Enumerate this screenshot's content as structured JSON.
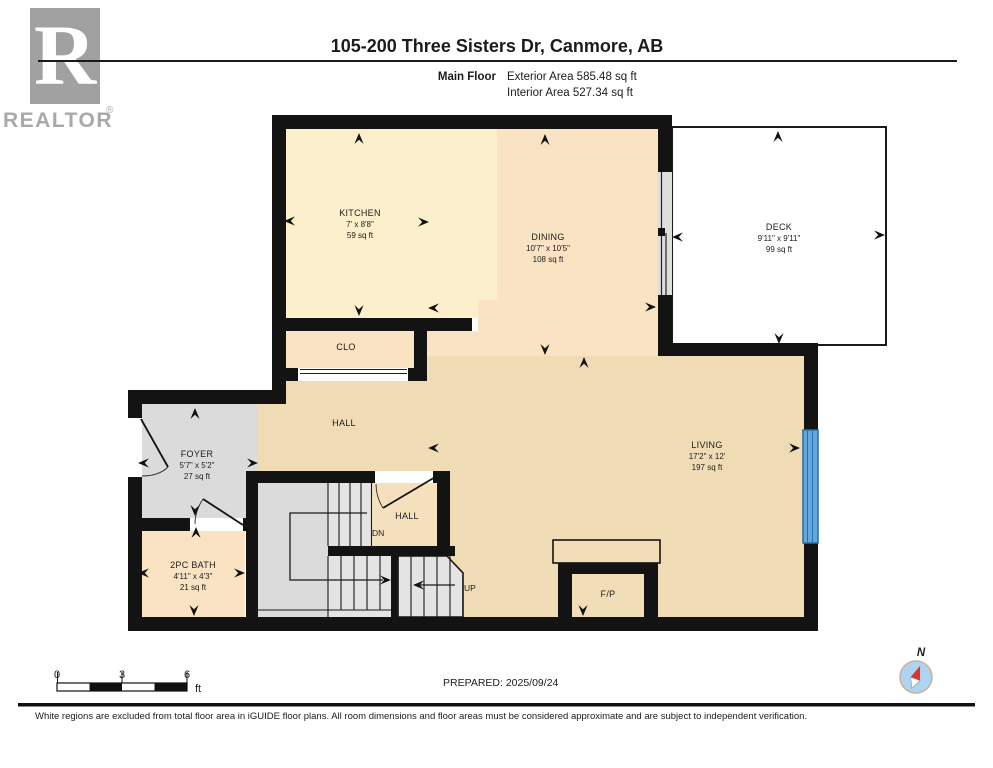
{
  "header": {
    "title": "105-200 Three Sisters Dr, Canmore, AB",
    "floor_label": "Main Floor",
    "exterior_area": "Exterior Area 585.48 sq ft",
    "interior_area": "Interior Area 527.34 sq ft",
    "logo_letter": "R",
    "logo_text": "REALTOR",
    "logo_reg": "®"
  },
  "rooms": {
    "kitchen": {
      "name": "KITCHEN",
      "dims": "7' x 8'8\"",
      "area": "59 sq ft"
    },
    "dining": {
      "name": "DINING",
      "dims": "10'7\" x 10'5\"",
      "area": "108 sq ft"
    },
    "deck": {
      "name": "DECK",
      "dims": "9'11\" x 9'11\"",
      "area": "99 sq ft"
    },
    "foyer": {
      "name": "FOYER",
      "dims": "5'7\" x 5'2\"",
      "area": "27 sq ft"
    },
    "living": {
      "name": "LIVING",
      "dims": "17'2\" x 12'",
      "area": "197 sq ft"
    },
    "bath": {
      "name": "2PC BATH",
      "dims": "4'11\" x 4'3\"",
      "area": "21 sq ft"
    }
  },
  "labels": {
    "clo": "CLO",
    "hall": "HALL",
    "hall2": "HALL",
    "dn": "DN",
    "up": "UP",
    "fp": "F/P"
  },
  "scale_bar": {
    "tick0": "0",
    "tick3": "3",
    "tick6": "6",
    "unit": "ft"
  },
  "footer": {
    "prepared": "PREPARED: 2025/09/24",
    "disclaimer": "White regions are excluded from total floor area in iGUIDE floor plans. All room dimensions and floor areas must be considered approximate and are subject to independent verification.",
    "compass_label": "N"
  },
  "colors": {
    "wall": "#131313",
    "kitchen_fill": "#FCEFCB",
    "dining_fill": "#F9E3C2",
    "hall_living_fill": "#EFDCB5",
    "small_hall_fill": "#F4E0BC",
    "foyer_fill": "#DBDBDB",
    "stair_tread_fill": "#E4E4E4",
    "deck_fill": "#FFFFFF",
    "window_blue": "#64A9DC",
    "window_blue_edge": "#2B6DA4",
    "slider_gray": "#DEDEDE",
    "compass_blue": "#AFD4F1",
    "compass_ring": "#C9B29A",
    "needle_red": "#D8342C",
    "logo_gray": "#A1A1A1"
  }
}
